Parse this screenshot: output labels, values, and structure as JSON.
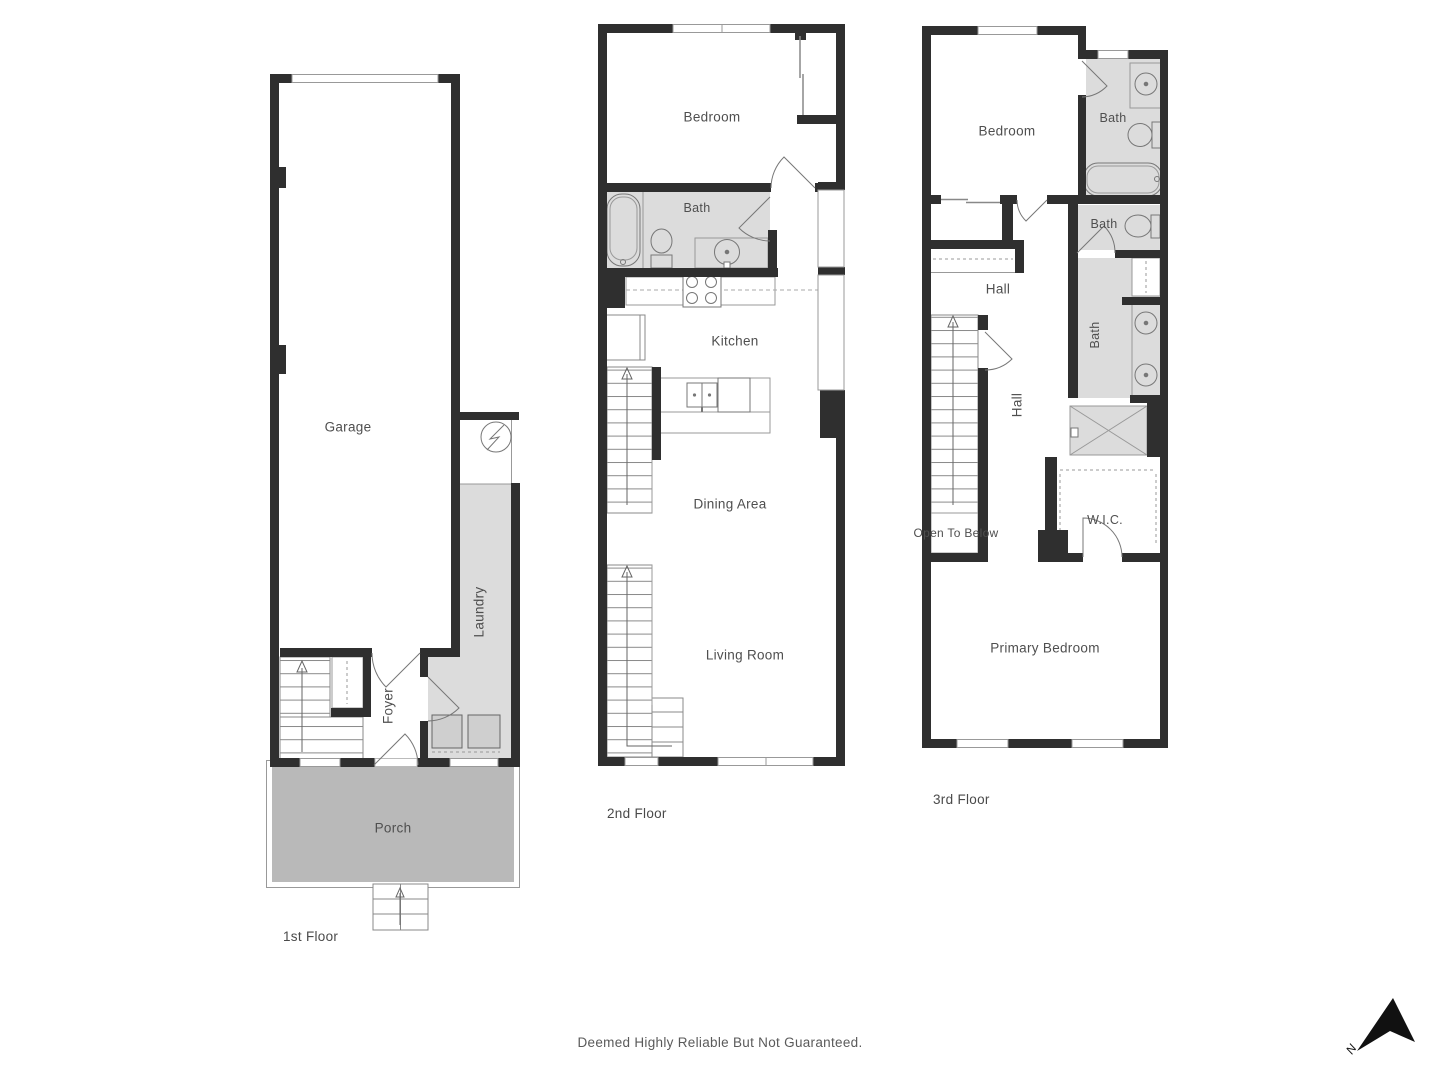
{
  "meta": {
    "disclaimer": "Deemed Highly Reliable But Not Guaranteed.",
    "north_label": "N"
  },
  "colors": {
    "wall": "#2f2f2f",
    "room_gray": "#dcdcdc",
    "porch_gray": "#b9b9b9",
    "line": "#8a8a8a",
    "label_text": "#4f4f4f"
  },
  "floors": [
    {
      "name": "1st Floor",
      "rooms": {
        "garage": "Garage",
        "laundry": "Laundry",
        "foyer": "Foyer",
        "porch": "Porch"
      }
    },
    {
      "name": "2nd Floor",
      "rooms": {
        "bedroom": "Bedroom",
        "bath": "Bath",
        "kitchen": "Kitchen",
        "dining": "Dining Area",
        "living": "Living Room"
      }
    },
    {
      "name": "3rd Floor",
      "rooms": {
        "bedroom": "Bedroom",
        "bath_top": "Bath",
        "bath_mid": "Bath",
        "hall_top": "Hall",
        "hall": "Hall",
        "bath": "Bath",
        "wic": "W.I.C.",
        "open_to_below": "Open To Below",
        "primary": "Primary Bedroom"
      }
    }
  ]
}
